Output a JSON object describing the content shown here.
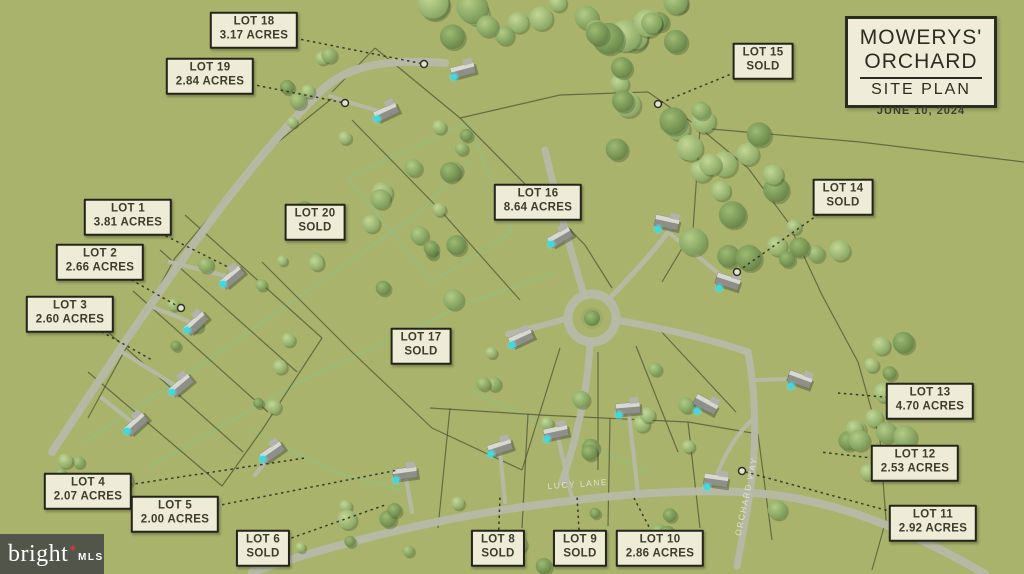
{
  "colors": {
    "background": "#a9b36c",
    "label_bg": "#eeebd7",
    "label_border": "#23241a",
    "road": "#b6baa9",
    "pool_accent": "#3fd9e2",
    "watermark_bg": "#4a4c48",
    "watermark_star": "#c2402f"
  },
  "map_title": {
    "line1": "MOWERYS'",
    "line2": "ORCHARD",
    "line3": "SITE PLAN",
    "date": "JUNE 10, 2024"
  },
  "watermark": {
    "brand": "bright",
    "star": "✱",
    "suffix": "MLS"
  },
  "road_labels": [
    {
      "text": "LUCY LANE",
      "x": 578,
      "y": 487,
      "angle": -4
    },
    {
      "text": "ORCHARD WAY",
      "x": 749,
      "y": 497,
      "angle": -78
    }
  ],
  "lots": [
    {
      "id": "1",
      "line1": "LOT 1",
      "line2": "3.81 ACRES",
      "x": 128,
      "y": 217,
      "leader": [
        230,
        268
      ],
      "dot": false
    },
    {
      "id": "2",
      "line1": "LOT 2",
      "line2": "2.66 ACRES",
      "x": 100,
      "y": 262,
      "leader": [
        181,
        308
      ],
      "dot": true
    },
    {
      "id": "3",
      "line1": "LOT 3",
      "line2": "2.60 ACRES",
      "x": 70,
      "y": 314,
      "leader": [
        152,
        360
      ],
      "dot": false
    },
    {
      "id": "4",
      "line1": "LOT 4",
      "line2": "2.07 ACRES",
      "x": 88,
      "y": 491,
      "leader": [
        305,
        458
      ],
      "dot": false
    },
    {
      "id": "5",
      "line1": "LOT 5",
      "line2": "2.00 ACRES",
      "x": 175,
      "y": 514,
      "leader": [
        398,
        470
      ],
      "dot": false
    },
    {
      "id": "6",
      "line1": "LOT 6",
      "line2": "SOLD",
      "x": 263,
      "y": 548,
      "leader": [
        385,
        505
      ],
      "dot": false
    },
    {
      "id": "8",
      "line1": "LOT 8",
      "line2": "SOLD",
      "x": 498,
      "y": 548,
      "leader": [
        500,
        497
      ],
      "dot": false
    },
    {
      "id": "9",
      "line1": "LOT 9",
      "line2": "SOLD",
      "x": 580,
      "y": 548,
      "leader": [
        577,
        496
      ],
      "dot": false
    },
    {
      "id": "10",
      "line1": "LOT 10",
      "line2": "2.86 ACRES",
      "x": 660,
      "y": 548,
      "leader": [
        634,
        498
      ],
      "dot": false
    },
    {
      "id": "11",
      "line1": "LOT 11",
      "line2": "2.92 ACRES",
      "x": 933,
      "y": 523,
      "leader": [
        742,
        471
      ],
      "dot": true
    },
    {
      "id": "12",
      "line1": "LOT 12",
      "line2": "2.53 ACRES",
      "x": 915,
      "y": 463,
      "leader": [
        820,
        452
      ],
      "dot": false
    },
    {
      "id": "13",
      "line1": "LOT 13",
      "line2": "4.70 ACRES",
      "x": 930,
      "y": 401,
      "leader": [
        838,
        393
      ],
      "dot": false
    },
    {
      "id": "14",
      "line1": "LOT 14",
      "line2": "SOLD",
      "x": 843,
      "y": 197,
      "leader": [
        737,
        272
      ],
      "dot": true
    },
    {
      "id": "15",
      "line1": "LOT 15",
      "line2": "SOLD",
      "x": 763,
      "y": 61,
      "leader": [
        658,
        104
      ],
      "dot": true
    },
    {
      "id": "16",
      "line1": "LOT 16",
      "line2": "8.64 ACRES",
      "x": 538,
      "y": 202,
      "leader": null,
      "dot": false
    },
    {
      "id": "17",
      "line1": "LOT 17",
      "line2": "SOLD",
      "x": 421,
      "y": 346,
      "leader": null,
      "dot": false
    },
    {
      "id": "18",
      "line1": "LOT 18",
      "line2": "3.17 ACRES",
      "x": 254,
      "y": 30,
      "leader": [
        424,
        64
      ],
      "dot": true
    },
    {
      "id": "19",
      "line1": "LOT 19",
      "line2": "2.84 ACRES",
      "x": 210,
      "y": 76,
      "leader": [
        345,
        103
      ],
      "dot": true
    },
    {
      "id": "20",
      "line1": "LOT 20",
      "line2": "SOLD",
      "x": 315,
      "y": 222,
      "leader": null,
      "dot": false
    }
  ]
}
